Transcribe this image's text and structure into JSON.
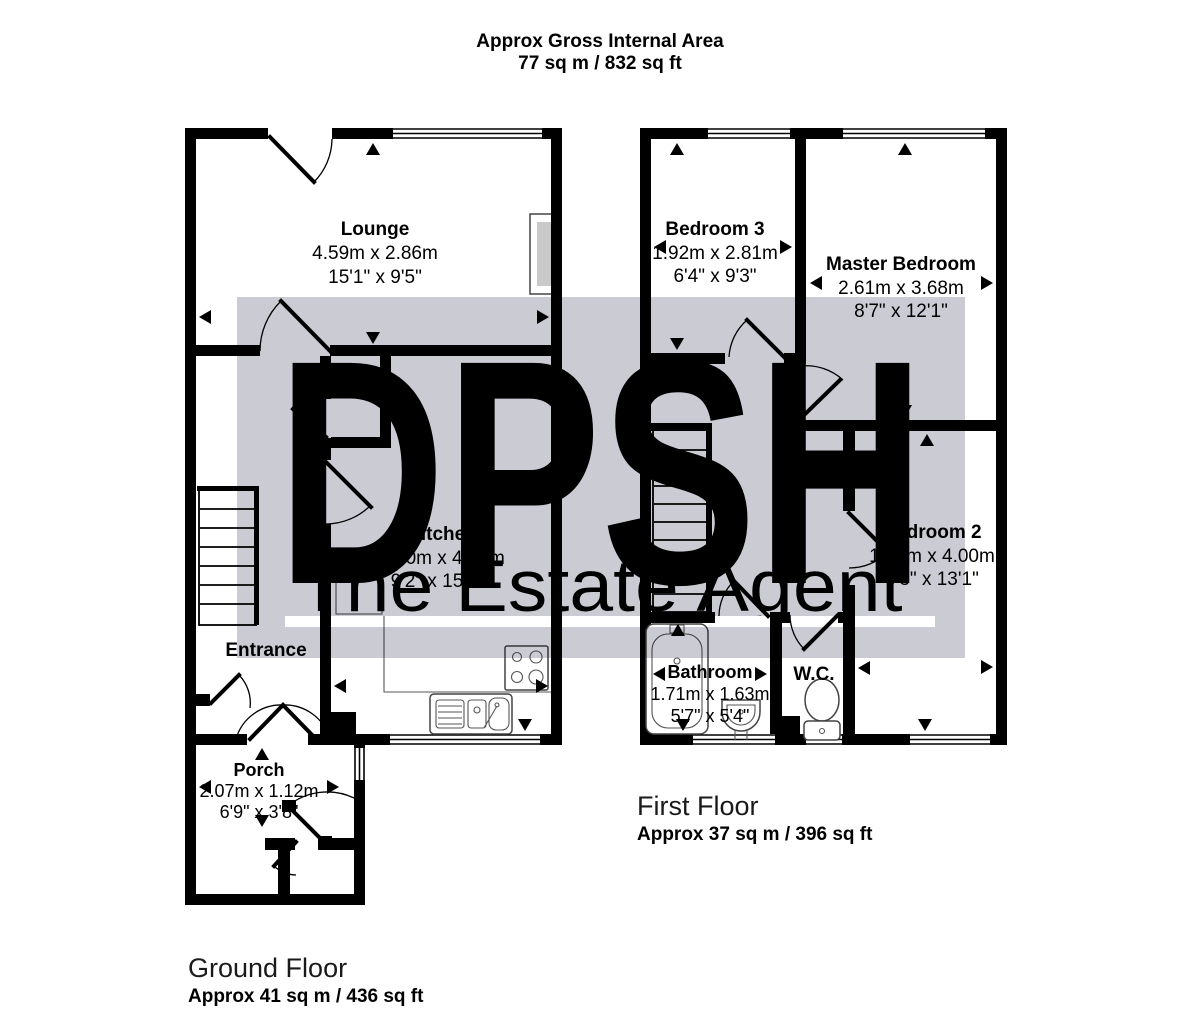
{
  "header": {
    "title": "Approx Gross Internal Area",
    "area": "77 sq m / 832 sq ft"
  },
  "watermark": {
    "logo": "DPSH",
    "tagline": "The Estate Agent",
    "band_color": "#cbcbd4",
    "text_color": "#ffffff"
  },
  "ground_floor": {
    "title": "Ground Floor",
    "area": "Approx 41 sq m / 436 sq ft",
    "rooms": {
      "lounge": {
        "name": "Lounge",
        "metric": "4.59m x 2.86m",
        "imperial": "15'1\" x 9'5\""
      },
      "kitchen": {
        "name": "Kitchen",
        "metric": "2.80m x 4.86m",
        "imperial": "9'2\" x 15'11\""
      },
      "entrance": {
        "name": "Entrance"
      },
      "porch": {
        "name": "Porch",
        "metric": "2.07m x 1.12m",
        "imperial": "6'9\" x 3'8\""
      }
    }
  },
  "first_floor": {
    "title": "First Floor",
    "area": "Approx 37 sq m / 396 sq ft",
    "rooms": {
      "bedroom3": {
        "name": "Bedroom 3",
        "metric": "1.92m x 2.81m",
        "imperial": "6'4\" x 9'3\""
      },
      "master": {
        "name": "Master Bedroom",
        "metric": "2.61m x 3.68m",
        "imperial": "8'7\" x 12'1\""
      },
      "bedroom2": {
        "name": "Bedroom 2",
        "metric": "1.90m x 4.00m",
        "imperial": "6'3\" x 13'1\""
      },
      "bathroom": {
        "name": "Bathroom",
        "metric": "1.71m x 1.63m",
        "imperial": "5'7\" x 5'4\""
      },
      "wc": {
        "name": "W.C."
      }
    }
  },
  "colors": {
    "wall": "#000000",
    "floor": "#ffffff",
    "chimney_fill": "#c9c9c9"
  }
}
